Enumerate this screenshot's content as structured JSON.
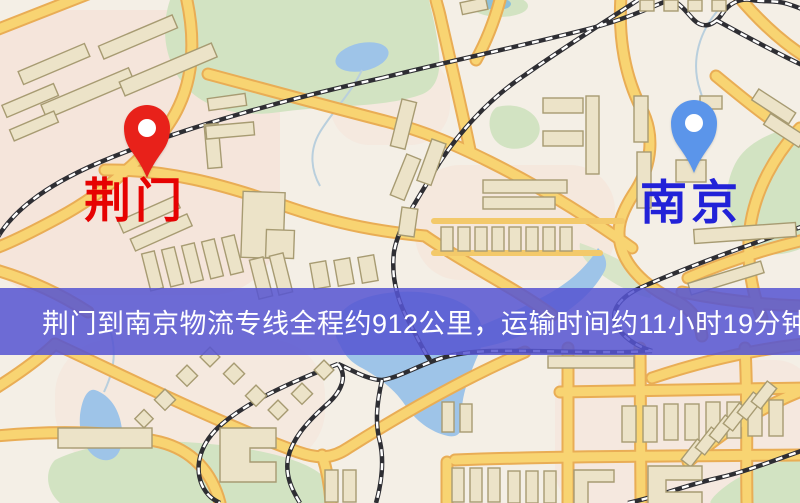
{
  "markers": {
    "origin": {
      "name": "荆门",
      "pin_color": "#e8211a",
      "label_color": "#e60202"
    },
    "destination": {
      "name": "南京",
      "pin_color": "#5b95ea",
      "label_color": "#2222d8"
    }
  },
  "banner": {
    "text": "荆门到南京物流专线全程约912公里，运输时间约11小时19分钟.",
    "origin": "荆门",
    "destination": "南京",
    "distance_km": "912",
    "duration": "11小时19分钟",
    "background_color": "#5655d2",
    "text_color": "#ffffff"
  },
  "map": {
    "colors": {
      "background": "#f4efe6",
      "urban_tint": "#f7d8cb",
      "road_fill": "#f8d472",
      "road_casing": "#e9ad55",
      "water": "#9ec4e8",
      "park": "#d2e3c2",
      "railway": "#2e2e33",
      "building_fill": "#ece3c8",
      "building_outline": "#a79b72"
    }
  }
}
